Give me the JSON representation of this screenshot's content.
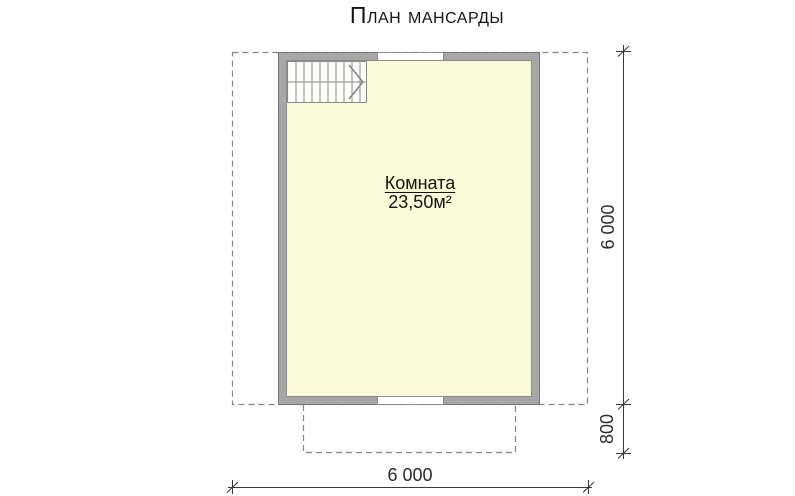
{
  "title": "План мансарды",
  "plan": {
    "room": {
      "label": "Комната",
      "area": "23,50м²"
    },
    "stairs": {
      "steps": 10,
      "direction": "right"
    }
  },
  "dimensions": {
    "overall_width": "6 000",
    "overall_height": "6 000",
    "balcony_depth": "800"
  },
  "colors": {
    "room_fill": "#fafad8",
    "wall_fill": "#a7a7a7",
    "wall_outline": "#757575",
    "dashed": "#858585",
    "dimension": "#3a3a3a",
    "text": "#1b1b1b"
  }
}
